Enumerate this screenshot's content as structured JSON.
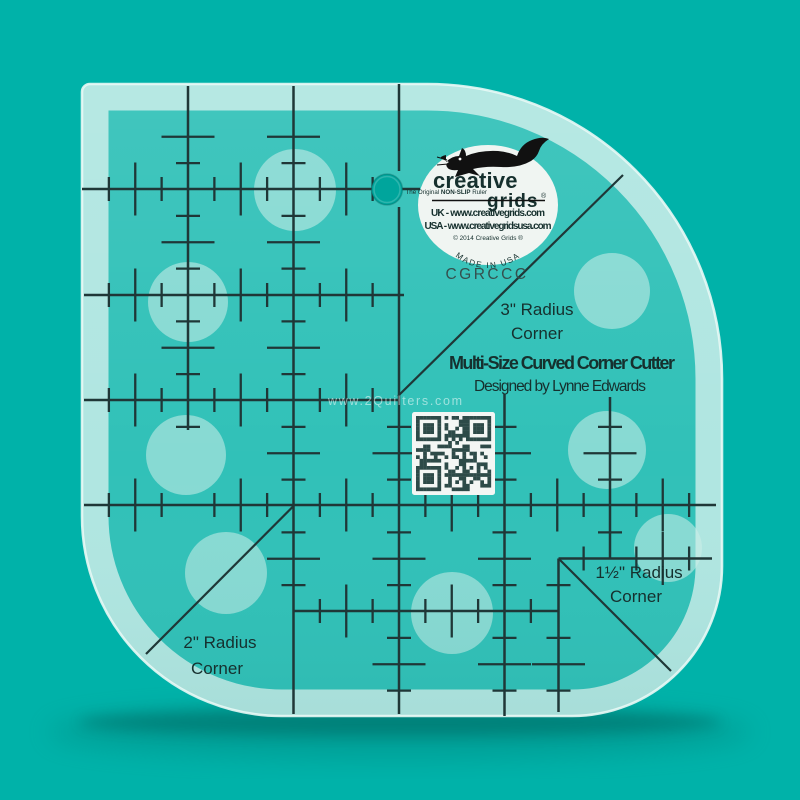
{
  "colors": {
    "background": "#00b2a9",
    "ruler_surface": "#31c1b8",
    "frosted": "#cdeeea",
    "marking": "#1f3737",
    "badge": "#f0f5f2",
    "text": "#16302e",
    "watermark": "rgba(255,255,255,0.52)",
    "hole": "#00a59c"
  },
  "badge": {
    "brand_top": "creative",
    "brand_bottom": "grids",
    "registered": "®",
    "tagline_prefix": "The Original ",
    "tagline_bold": "NON-SLIP",
    "tagline_suffix": " Ruler",
    "contact_uk": "UK - www.creativegrids.com",
    "contact_usa": "USA - www.creativegridsusa.com",
    "copyright": "© 2014 Creative Grids ®",
    "made_in": "MADE IN USA",
    "product_code": "CGRCCC"
  },
  "title": {
    "name": "Multi-Size Curved Corner Cutter",
    "designer": "Designed by Lynne Edwards"
  },
  "corner_labels": {
    "three": {
      "line1": "3\" Radius",
      "line2": "Corner"
    },
    "one_half": {
      "line1": "1½\" Radius",
      "line2": "Corner"
    },
    "two": {
      "line1": "2\" Radius",
      "line2": "Corner"
    }
  },
  "watermark": "www.2Quilters.com",
  "icons": {
    "logo_animal": "fox-icon",
    "qr": "qr-code-icon",
    "hanging_hole": "hanging-hole"
  }
}
